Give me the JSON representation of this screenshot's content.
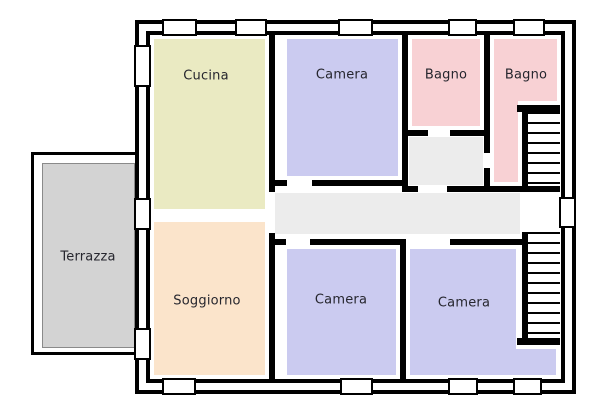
{
  "page": {
    "background": "#ffffff"
  },
  "palette": {
    "wall": "#000000",
    "label_text": "#26262e",
    "window_fill": "#ffffff",
    "corridor": "#ececec",
    "vestibule": "#ececec",
    "terrace_border": "#8a8a8a"
  },
  "rooms": {
    "cucina": {
      "label": "Cucina",
      "color": "#eaeac2"
    },
    "camera_top": {
      "label": "Camera",
      "color": "#cbcbf0"
    },
    "bagno_left": {
      "label": "Bagno",
      "color": "#f8d1d4"
    },
    "bagno_right": {
      "label": "Bagno",
      "color": "#f8d1d4"
    },
    "terrazza": {
      "label": "Terrazza",
      "color": "#d3d3d3"
    },
    "soggiorno": {
      "label": "Soggiorno",
      "color": "#fbe4cb"
    },
    "camera_bottom_left": {
      "label": "Camera",
      "color": "#cbcbf0"
    },
    "camera_bottom_right": {
      "label": "Camera",
      "color": "#cbcbf0"
    }
  }
}
